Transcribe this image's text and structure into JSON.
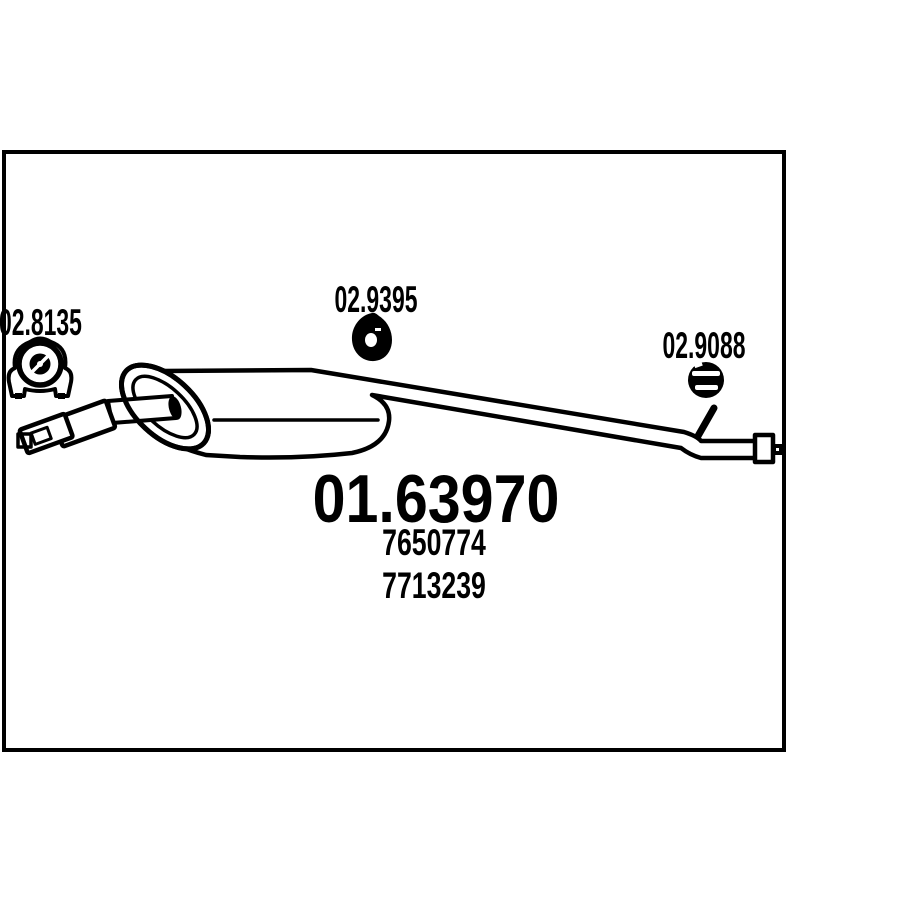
{
  "colors": {
    "ink": "#000000",
    "paper": "#ffffff"
  },
  "diagram": {
    "type": "exhaust-silencer-technical-drawing",
    "fitting_labels": [
      {
        "code": "02.8135",
        "icon": "mounting-clamp-icon"
      },
      {
        "code": "02.9395",
        "icon": "rubber-hanger-icon"
      },
      {
        "code": "02.9088",
        "icon": "rubber-grommet-icon"
      }
    ],
    "part_code": "01.63970",
    "oem_references": [
      "7650774",
      "7713239"
    ]
  }
}
